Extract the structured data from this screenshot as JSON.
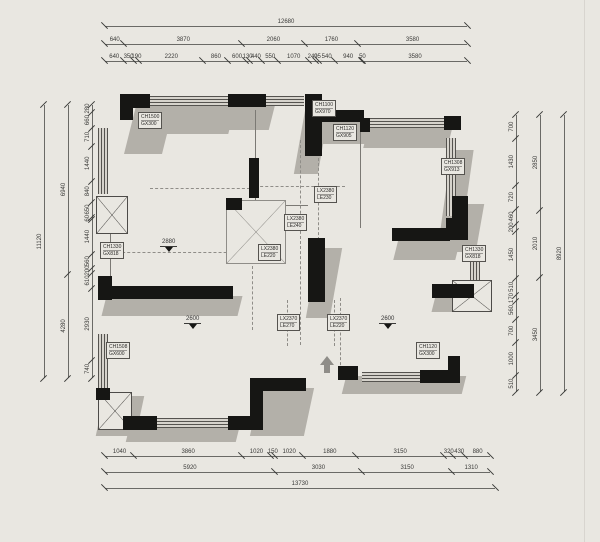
{
  "drawing": {
    "type": "floor-plan",
    "background_color": "#e9e7e1",
    "wall_color": "#161614",
    "shadow_color": "#b3b0a9",
    "dim_text_color": "#3a3a38"
  },
  "dimensions": {
    "top": {
      "total": "12680",
      "row2": [
        "640",
        "3870",
        "2060",
        "1760",
        "3580"
      ],
      "row3": [
        "640",
        "350",
        "190",
        "2220",
        "860",
        "600",
        "130",
        "440",
        "550",
        "1070",
        "240",
        "95",
        "540",
        "940",
        "50",
        "3580"
      ]
    },
    "bottom": {
      "row1": [
        "1040",
        "3860",
        "1020",
        "150",
        "1020",
        "1880",
        "3150",
        "320",
        "430",
        "880"
      ],
      "row2": [
        "5920",
        "3030",
        "3150",
        "1310"
      ],
      "total": "13730"
    },
    "left": {
      "total": "11120",
      "mid": [
        "6940",
        "4280"
      ],
      "inner": [
        "280",
        "660",
        "710",
        "1440",
        "840",
        "650",
        "60",
        "1440",
        "560",
        "200",
        "610",
        "2930",
        "740"
      ]
    },
    "right": {
      "total": "8920",
      "mid": [
        "2850",
        "2010",
        "3450"
      ],
      "inner": [
        "700",
        "1430",
        "720",
        "460",
        "200",
        "1450",
        "510",
        "170",
        "560",
        "700",
        "1000",
        "510"
      ]
    }
  },
  "tags": [
    {
      "line1": "CH1500",
      "line2": "GX300"
    },
    {
      "line1": "CH1100",
      "line2": "GX970"
    },
    {
      "line1": "CH1120",
      "line2": "GX905"
    },
    {
      "line1": "LX2380",
      "line2": "LE230"
    },
    {
      "line1": "LX2380",
      "line2": "LE240"
    },
    {
      "line1": "LX2380",
      "line2": "LE220"
    },
    {
      "line1": "LX2370",
      "line2": "LE270"
    },
    {
      "line1": "LX2370",
      "line2": "LE220"
    },
    {
      "line1": "CH1308",
      "line2": "GX913"
    },
    {
      "line1": "CH1330",
      "line2": "GX818"
    },
    {
      "line1": "CH1330",
      "line2": "GX818"
    },
    {
      "line1": "CH1508",
      "line2": "GX600"
    },
    {
      "line1": "CH1120",
      "line2": "GX300"
    }
  ],
  "marks": [
    {
      "value": "2880"
    },
    {
      "value": "2600"
    },
    {
      "value": "2600"
    }
  ]
}
